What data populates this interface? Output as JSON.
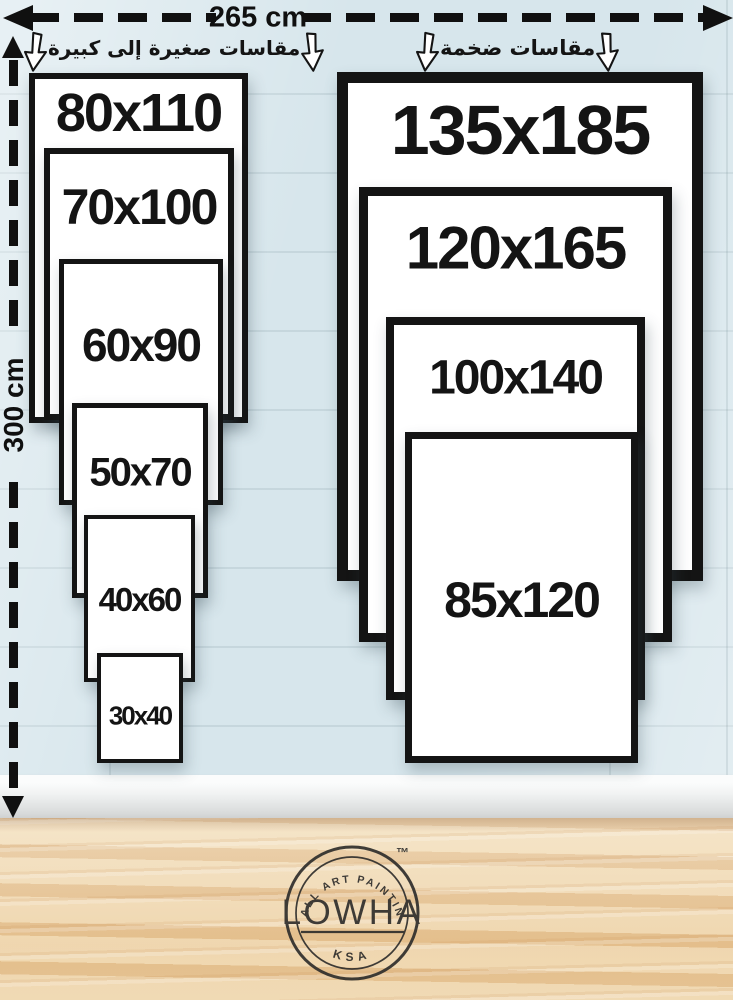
{
  "rulers": {
    "width_label": "265 cm",
    "height_label": "300 cm"
  },
  "headings": {
    "left": "مقاسات صغيرة إلى كبيرة",
    "right": "مقاسات ضخمة"
  },
  "left_frames": [
    {
      "label": "80x110"
    },
    {
      "label": "70x100"
    },
    {
      "label": "60x90"
    },
    {
      "label": "50x70"
    },
    {
      "label": "40x60"
    },
    {
      "label": "30x40"
    }
  ],
  "right_frames": [
    {
      "label": "135x185"
    },
    {
      "label": "120x165"
    },
    {
      "label": "100x140"
    },
    {
      "label": "85x120"
    }
  ],
  "logo": {
    "arc_top": "WALL ART PAINTING",
    "name": "LOWHA",
    "arc_bottom": "KSA",
    "trademark": "™"
  },
  "colors": {
    "wall": "#d7e6ec",
    "frame_border": "#141414",
    "text": "#101010",
    "baseboard": "#eef0f0",
    "floor_wood": "#ecd2ab"
  }
}
